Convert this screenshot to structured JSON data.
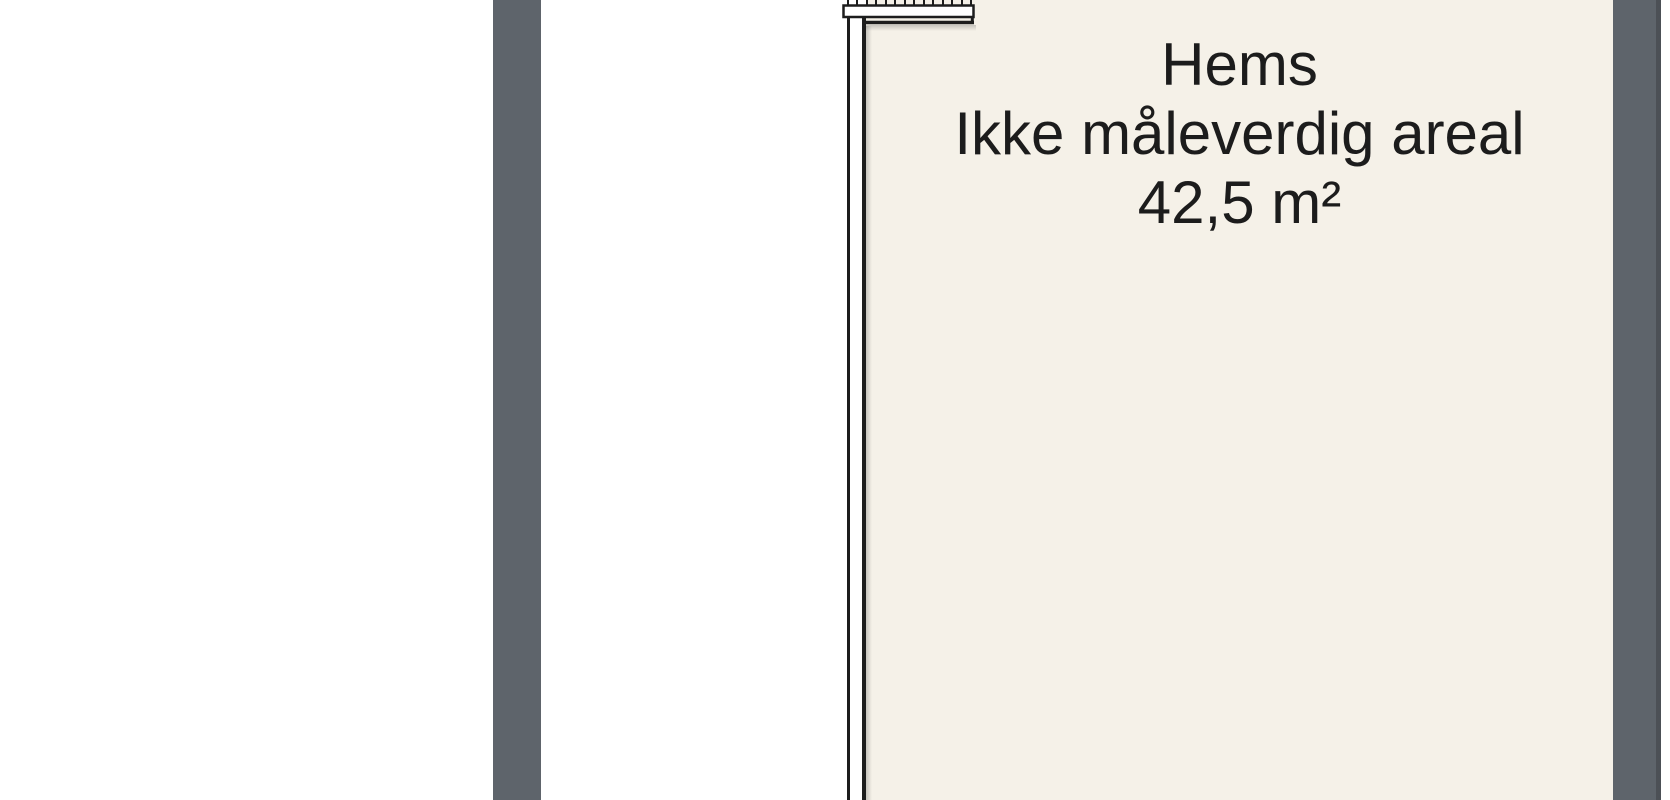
{
  "room": {
    "label": "Hems",
    "note": "Ikke måleverdig areal",
    "area": "42,5 m²"
  },
  "colors": {
    "exterior_wall_gray": "#5e646b",
    "exterior_wall_edge_dark": "#4c5056",
    "room_fill": "#f5f1e8",
    "wall_line_dark": "#1d1d1d",
    "text_dark": "#1c1c1c",
    "background": "#ffffff"
  },
  "icons": {
    "stair_ladder": "stair-ladder-icon"
  }
}
